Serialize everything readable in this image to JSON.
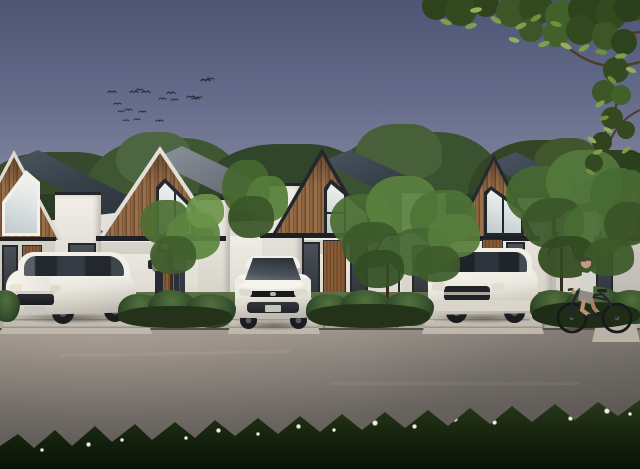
{
  "scene": {
    "type": "architectural exterior rendering",
    "time_of_day": "dusk",
    "description": "Dusk rendering of a row of modern minimalist gable townhouses with vertical wood-slat gable facades and white walls; white minivan, hatchback and SUV parked in concrete driveways; two people at an entry porch; a cyclist riding past on the asphalt road; a flock of birds in a blue-violet sky; a leafy branch overhanging the top right; dark shrubs and a foreground strip of grass with white flowers.",
    "counts": {
      "houses_fully_visible": 3,
      "houses_partially_visible": 2,
      "cars": 3,
      "pedestrians": 2,
      "cyclists": 1,
      "birds": 19,
      "front_yard_trees": 4,
      "driveways": 3,
      "gable_windows": 5
    },
    "objects": [
      {
        "name": "sky",
        "label": "Gradient dusk sky, violet-blue to warm gray at horizon"
      },
      {
        "name": "birds-flock",
        "label": "Flock of small birds flying upper left"
      },
      {
        "name": "background-trees",
        "label": "Dense dark tree line behind the houses"
      },
      {
        "name": "house-row",
        "label": "Row of gable houses with wood-slat facades and dark roofs"
      },
      {
        "name": "gable-window",
        "label": "Large angular picture windows in each gable"
      },
      {
        "name": "car-minivan",
        "label": "White MPV parked in left driveway"
      },
      {
        "name": "car-hatchback",
        "label": "White hatchback parked in center driveway"
      },
      {
        "name": "car-suv",
        "label": "White compact SUV parked in right driveway"
      },
      {
        "name": "pedestrians",
        "label": "Two people standing at the second house entry"
      },
      {
        "name": "cyclist",
        "label": "Man in light shirt and cap riding a bicycle to the left"
      },
      {
        "name": "yard-trees",
        "label": "Bright green ornamental trees in the front yards"
      },
      {
        "name": "shrub-beds",
        "label": "Tropical shrub planting beds between driveways"
      },
      {
        "name": "sidewalk",
        "label": "Concrete sidewalk with diagonal joints"
      },
      {
        "name": "road",
        "label": "Asphalt road across the foreground"
      },
      {
        "name": "foreground-grass",
        "label": "Dark grass strip with white puffball flowers at bottom edge"
      },
      {
        "name": "overhanging-branch",
        "label": "Leafy tree branch overhanging from top right corner"
      }
    ]
  },
  "palette": {
    "sky_top": "#4d5574",
    "sky_mid": "#8b8da3",
    "sky_horizon": "#cac3b8",
    "background_trees": "#36492c",
    "roof_dark": "#2a323c",
    "roof_light": "#8e949c",
    "wood_facade": "#8d6542",
    "trim_dark": "#23262b",
    "trim_white": "#e3dfd8",
    "wall_white": "#f0ede5",
    "glass_bright": "#e2e7e6",
    "door_wood": "#8a5c38",
    "lawn": "#5d7244",
    "shrub": "#35502c",
    "foliage_light": "#5a8140",
    "foliage_dark": "#31491f",
    "sidewalk": "#b3ada3",
    "driveway": "#c7c1b5",
    "road": "#6b6661",
    "foreground_grass": "#16230e",
    "flower_white": "#eef0ea",
    "car_white": "#eae7de",
    "car_glass": "#2a3036",
    "bird": "#2b2f3b",
    "skin": "#bd9272",
    "shirt": "#d6d3cb"
  }
}
